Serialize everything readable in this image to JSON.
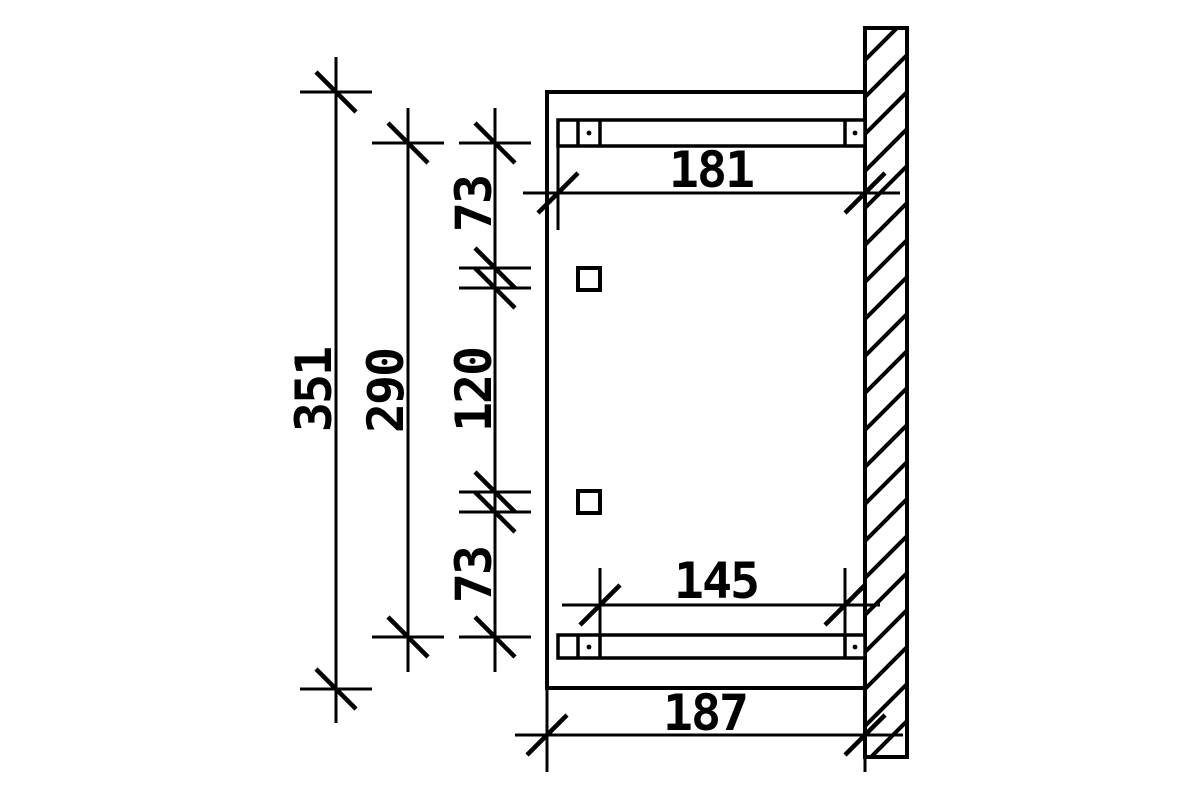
{
  "drawing": {
    "background": "#ffffff",
    "ink_color": "#000000",
    "kind": "side-view dimension drawing of wall-mounted canopy frame"
  },
  "dimensions": {
    "vertical": [
      {
        "name": "total-height",
        "label": "351"
      },
      {
        "name": "beam-to-beam",
        "label": "290"
      },
      {
        "name": "upper-spacing",
        "label": "73"
      },
      {
        "name": "rafter-spacing",
        "label": "120"
      },
      {
        "name": "lower-spacing",
        "label": "73"
      }
    ],
    "horizontal": [
      {
        "name": "top-beam-projection",
        "label": "181"
      },
      {
        "name": "bottom-beam-span",
        "label": "145"
      },
      {
        "name": "total-projection",
        "label": "187"
      }
    ]
  }
}
